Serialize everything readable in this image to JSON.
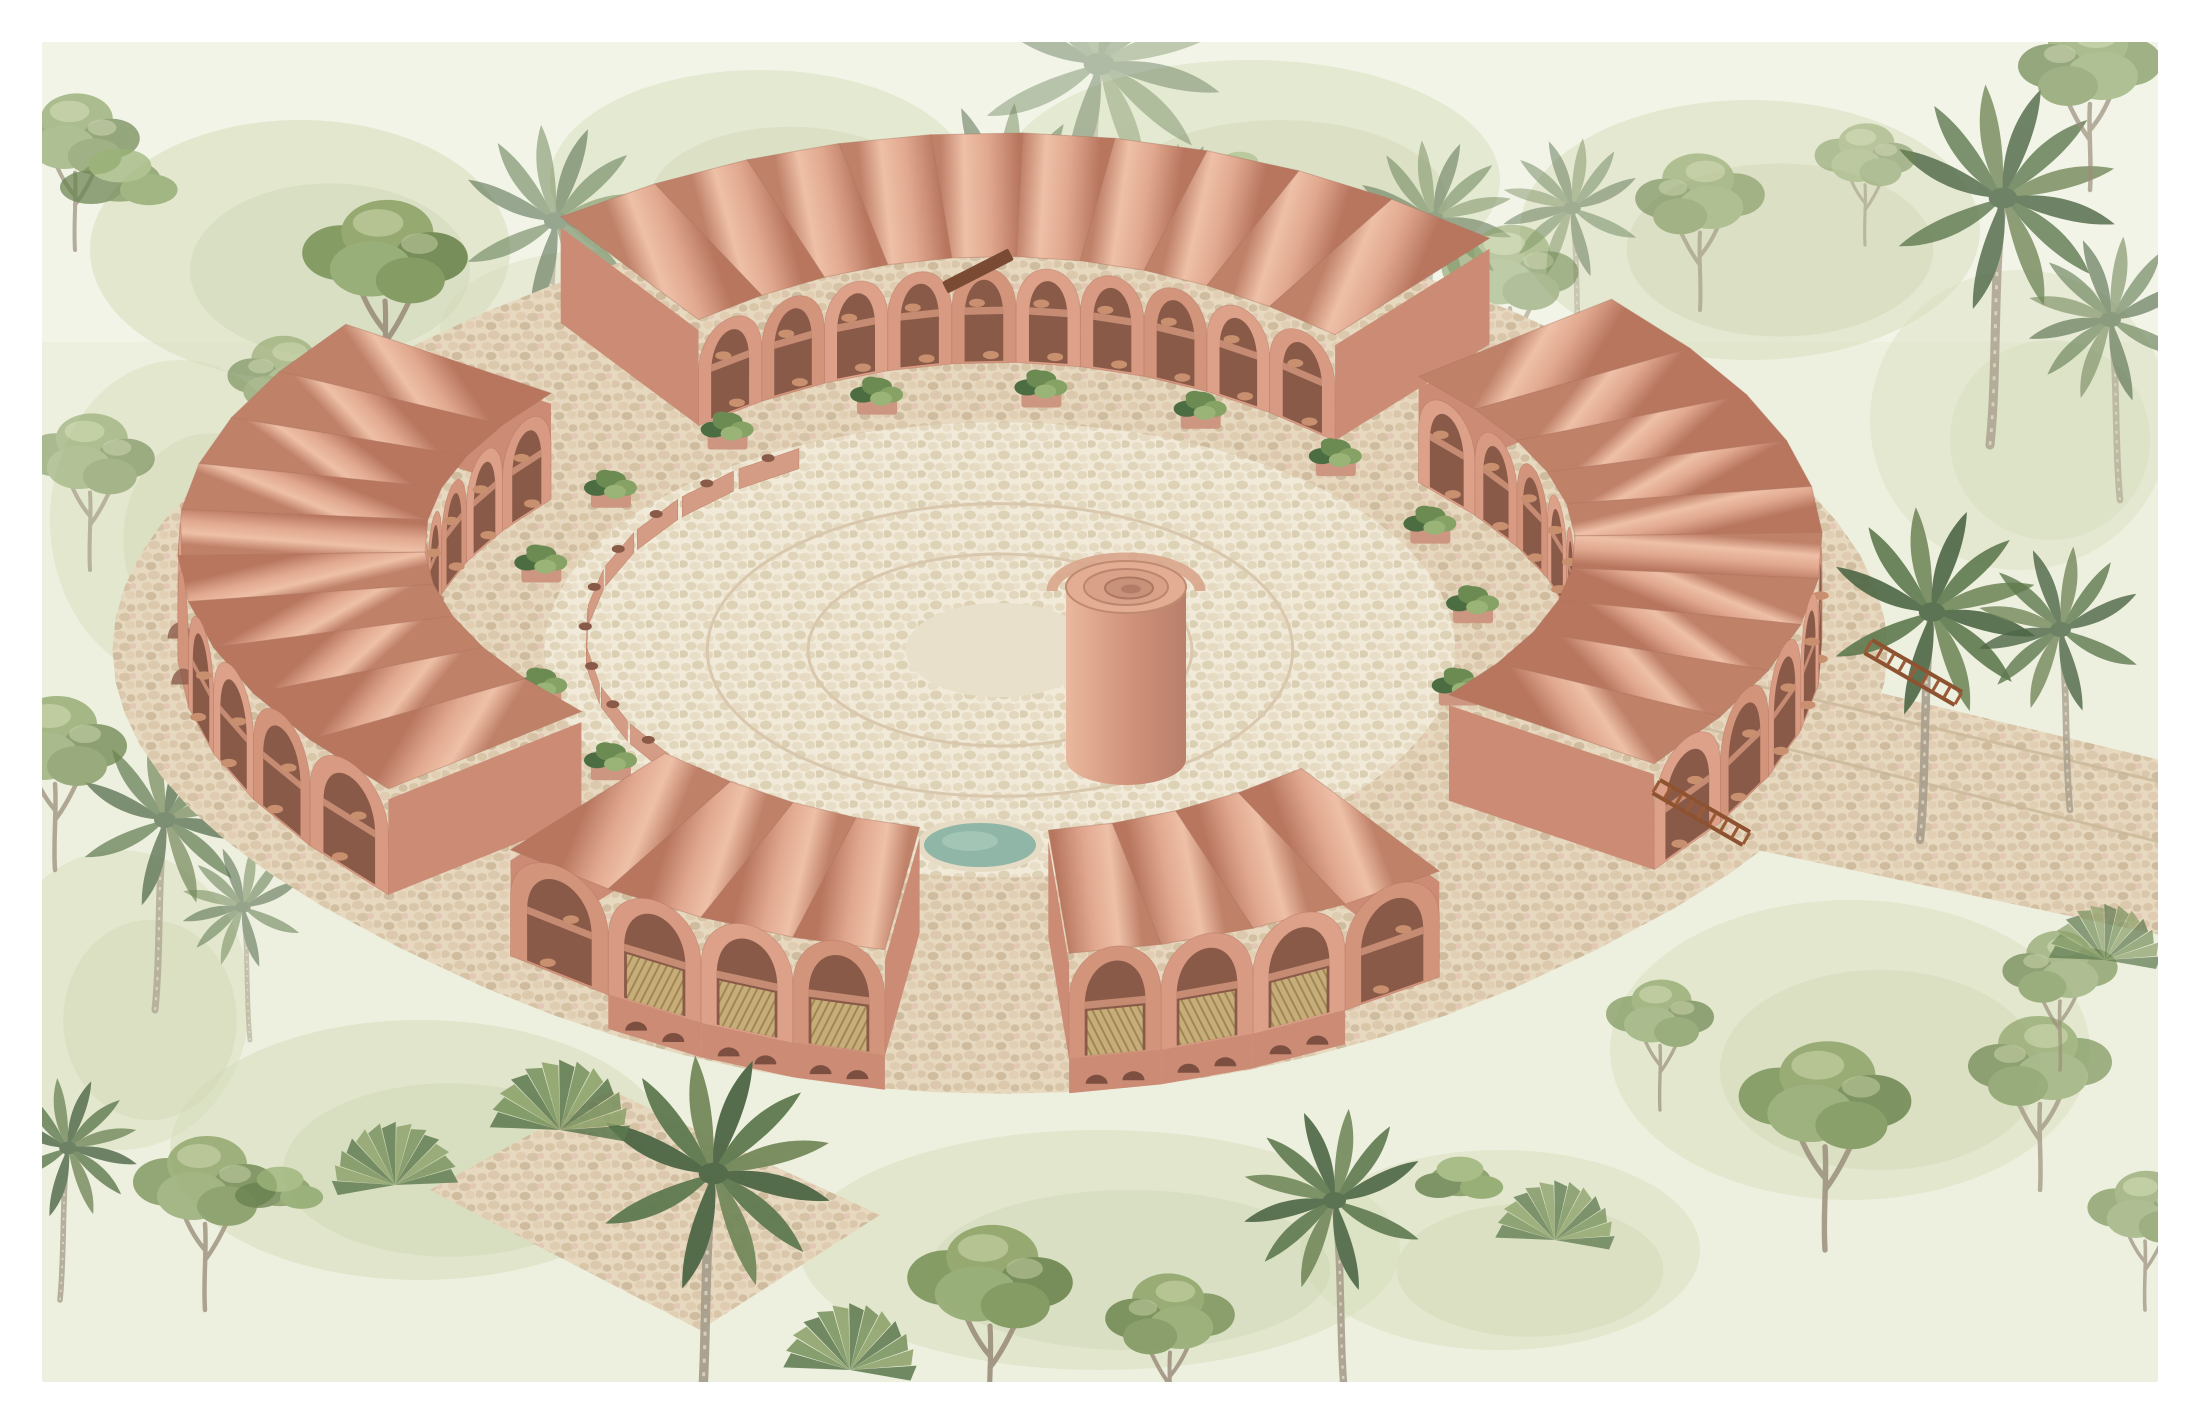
{
  "scene": {
    "title": "Watercolor axonometric rendering of a terracotta barrel-vaulted courtyard building in a tropical jungle",
    "canvas": {
      "width": 2200,
      "height": 1424,
      "border": 42,
      "page_color": "#ffffff",
      "paper_color": "#eef0df"
    },
    "palette": {
      "paper_edge": "#f6f7ec",
      "wash_green": "#d6ddbb",
      "wash_green2": "#c9d2ad",
      "vault_light": "#eec0a7",
      "vault_mid": "#e0a78e",
      "vault_dark": "#c08169",
      "vault_deep": "#b8765f",
      "wall": [
        "#d89a82",
        "#d3947c",
        "#dda089"
      ],
      "wall_shade": "#cb8b74",
      "arch_dark": "#8a5a49",
      "arch_deeper": "#7c4f41",
      "slab": "#c68b73",
      "pot": "#c9906f",
      "wood_slat": "#c9b17c",
      "wood_slat_line": "#9e854f",
      "stair_wood": "#8d5230",
      "beam_wood": "#7a4a33",
      "cobble_bg": "#e7d9c0",
      "cobble_stones": [
        "#d9c6a8",
        "#dcc9ad",
        "#d2bfa2",
        "#e0cdb1",
        "#d6c3a6",
        "#dac7ab",
        "#cfbc9f",
        "#e2cfb3",
        "#e4c8b5"
      ],
      "court_bg": "#f1ead8",
      "court_stones": [
        "#e4d9bf",
        "#ded2b6",
        "#e9dfc8",
        "#e0d4ba",
        "#e6dbc2",
        "#dbcfb3",
        "#e8ddc6",
        "#e2d6bc",
        "#eadfca"
      ],
      "court_ring": "#d9c8ae",
      "pool_water": "#8fb6a6",
      "pool_light": "#a8c9ba",
      "pool_rim": "#e6dcc5",
      "tower_light": "#e9b89e",
      "tower_mid": "#d09179",
      "tower_dark": "#b97f6b",
      "tower_top": "#e3ad93",
      "tower_rim": "#c08a72",
      "leaf_dark": "#4c6d41",
      "leaf_mid": "#6b8b52",
      "leaf_light": "#86a264",
      "leaf_pale": "#9ab377",
      "canopy": [
        "#7d955c",
        "#8ea469",
        "#6d8650",
        "#93aa72",
        "#7d955c"
      ],
      "canopy_hi": "#b9c795",
      "trunk": "#a89f8d",
      "trunk_hi": "#d6cdb9",
      "frond_a": "#4e6746",
      "frond_b": "#5f7a50",
      "frond_c": "#74895c"
    },
    "building": {
      "cx": 1000,
      "cy": 650,
      "k": 1.15,
      "R": 400,
      "exp": 0.82,
      "tubes": 46,
      "len_out": 80,
      "len_in": 72,
      "valley_h": 106,
      "front_band_h": 34,
      "gaps": [
        {
          "a": 0,
          "w": 5
        },
        {
          "a": 45,
          "w": 9
        },
        {
          "a": 90,
          "w": 5
        },
        {
          "a": 180,
          "w": 5
        },
        {
          "a": 270,
          "w": 5
        }
      ],
      "gable_angle": 135,
      "gable_halfwidth": 8,
      "front_range": [
        12,
        78
      ]
    },
    "courtyard": {
      "floor_radius": 280,
      "ring_radii": [
        180,
        118
      ],
      "center_disc": 58,
      "planter_radius": 292,
      "planter_angles": [
        60,
        100,
        120,
        150,
        170,
        190,
        210,
        230,
        250,
        270,
        290,
        310,
        330
      ],
      "wall_radius": 255,
      "wall_from": 70,
      "wall_to": 200,
      "wall_step": 11,
      "wall_height": 20
    },
    "tower": {
      "x": 1126,
      "base_y": 759,
      "body_h": 172,
      "rx": 60,
      "ry": 26
    },
    "pool": {
      "x": 980,
      "y": 845,
      "rx": 56,
      "ry": 22
    },
    "beam": {
      "x": 942,
      "y": 282,
      "w": 74,
      "h": 13,
      "angle": -27
    },
    "stairs": [
      {
        "x": 1872,
        "y": 640,
        "angle": 30,
        "steps": 8
      },
      {
        "x": 1660,
        "y": 780,
        "angle": 30,
        "steps": 8
      }
    ],
    "paths": {
      "right_band": [
        [
          1660,
          640
        ],
        [
          2160,
          760
        ],
        [
          2160,
          935
        ],
        [
          1520,
          800
        ]
      ],
      "bottom_band": [
        [
          610,
          1090
        ],
        [
          880,
          1215
        ],
        [
          700,
          1330
        ],
        [
          430,
          1190
        ]
      ],
      "apron_offset": 120
    },
    "washes": [
      [
        300,
        250,
        420,
        260,
        0.7
      ],
      [
        760,
        180,
        420,
        220,
        0.6
      ],
      [
        1250,
        180,
        500,
        240,
        0.6
      ],
      [
        1750,
        230,
        460,
        260,
        0.65
      ],
      [
        2020,
        420,
        300,
        300,
        0.5
      ],
      [
        180,
        520,
        260,
        320,
        0.6
      ],
      [
        420,
        1150,
        500,
        260,
        0.7
      ],
      [
        1100,
        1250,
        600,
        240,
        0.65
      ],
      [
        1850,
        1050,
        480,
        300,
        0.6
      ],
      [
        120,
        1000,
        260,
        300,
        0.6
      ],
      [
        600,
        330,
        320,
        160,
        0.5
      ],
      [
        1500,
        1250,
        400,
        200,
        0.6
      ]
    ],
    "vegetation_back": [
      [
        "palm",
        545,
        430,
        1.1,
        0.55,
        0
      ],
      [
        "palm",
        1010,
        450,
        1.25,
        0.5,
        1
      ],
      [
        "palm",
        1085,
        330,
        1.4,
        0.4,
        0
      ],
      [
        "palm",
        1180,
        310,
        0.6,
        0.45,
        0
      ],
      [
        "palm",
        1425,
        390,
        0.9,
        0.5,
        0
      ],
      [
        "palm",
        1580,
        360,
        0.8,
        0.45,
        1
      ],
      [
        "palm",
        1990,
        445,
        1.3,
        0.8,
        0
      ],
      [
        "palm",
        2120,
        500,
        0.95,
        0.6,
        1
      ],
      [
        "palm",
        155,
        1010,
        1.0,
        0.7,
        0
      ],
      [
        "palm",
        250,
        1040,
        0.7,
        0.55,
        1
      ],
      [
        "tree",
        385,
        400,
        1.15,
        0.9,
        0
      ],
      [
        "tree",
        285,
        475,
        0.8,
        0.6,
        1
      ],
      [
        "tree",
        75,
        250,
        0.9,
        0.7,
        0
      ],
      [
        "tree",
        875,
        310,
        0.8,
        0.5,
        1
      ],
      [
        "tree",
        1115,
        340,
        0.7,
        0.45,
        0
      ],
      [
        "tree",
        1510,
        390,
        0.95,
        0.55,
        0
      ],
      [
        "tree",
        1700,
        310,
        0.9,
        0.6,
        1
      ],
      [
        "tree",
        1865,
        245,
        0.7,
        0.5,
        0
      ],
      [
        "tree",
        2090,
        190,
        1.0,
        0.7,
        1
      ],
      [
        "tree",
        90,
        570,
        0.9,
        0.6,
        0
      ],
      [
        "tree",
        55,
        870,
        1.0,
        0.75,
        0
      ],
      [
        "bush",
        120,
        180,
        1.2,
        0.7,
        0
      ],
      [
        "bush",
        620,
        480,
        0.8,
        0.45,
        0
      ],
      [
        "bush",
        1240,
        170,
        0.7,
        0.5,
        0
      ],
      [
        "bush",
        1290,
        310,
        0.6,
        0.5,
        1
      ],
      [
        "fan",
        345,
        770,
        0.7,
        0.5,
        0
      ],
      [
        "bush",
        340,
        870,
        0.7,
        0.5,
        1
      ]
    ],
    "vegetation_front": [
      [
        "palm",
        1920,
        840,
        1.2,
        0.9,
        0
      ],
      [
        "palm",
        2070,
        810,
        0.95,
        0.8,
        1
      ],
      [
        "palm",
        700,
        1430,
        1.35,
        0.95,
        0
      ],
      [
        "palm",
        1345,
        1400,
        1.05,
        0.9,
        1
      ],
      [
        "palm",
        60,
        1300,
        0.8,
        0.8,
        0
      ],
      [
        "tree",
        1825,
        1250,
        1.2,
        0.85,
        0
      ],
      [
        "tree",
        2040,
        1190,
        1.0,
        0.7,
        1
      ],
      [
        "tree",
        990,
        1425,
        1.15,
        0.9,
        0
      ],
      [
        "tree",
        1170,
        1430,
        0.9,
        0.85,
        1
      ],
      [
        "tree",
        205,
        1310,
        1.0,
        0.8,
        0
      ],
      [
        "tree",
        2145,
        1310,
        0.8,
        0.7,
        0
      ],
      [
        "tree",
        1660,
        1110,
        0.75,
        0.7,
        0
      ],
      [
        "tree",
        2060,
        1070,
        0.8,
        0.7,
        1
      ],
      [
        "fan",
        560,
        1130,
        1.0,
        0.85,
        0
      ],
      [
        "fan",
        395,
        1185,
        0.9,
        0.8,
        1
      ],
      [
        "fan",
        2105,
        960,
        0.8,
        0.7,
        0
      ],
      [
        "fan",
        1555,
        1240,
        0.85,
        0.75,
        0
      ],
      [
        "fan",
        850,
        1370,
        0.95,
        0.85,
        0
      ],
      [
        "bush",
        1460,
        1180,
        0.9,
        0.8,
        0
      ],
      [
        "bush",
        280,
        1190,
        0.9,
        0.75,
        0
      ]
    ]
  }
}
